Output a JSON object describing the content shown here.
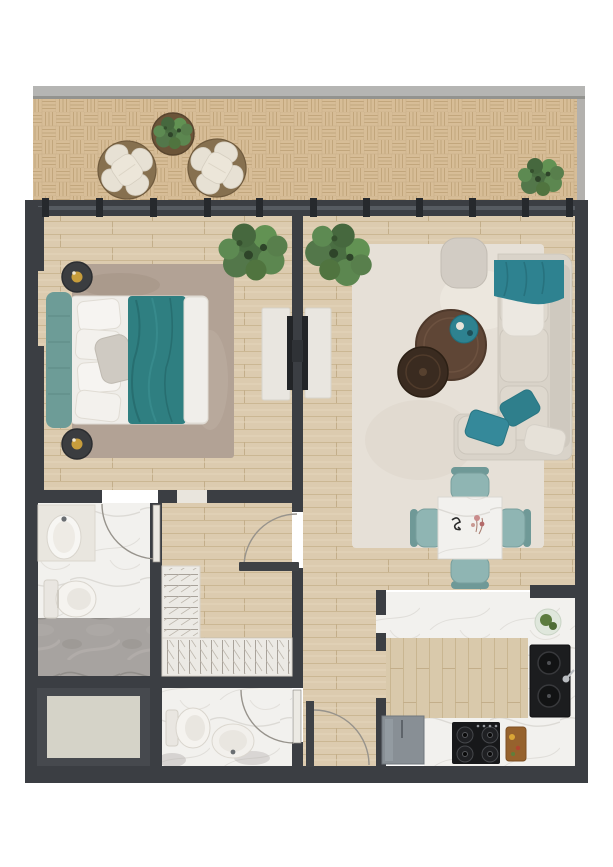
{
  "meta": {
    "title": "apartment-floor-plan",
    "description": "Top-down rendered floor plan of a one-bedroom apartment with balcony",
    "visible_text": []
  },
  "palette": {
    "wall": "#3b3e43",
    "wallDark": "#26292d",
    "glass": "#565b61",
    "rail": "#b5b5b3",
    "rugBedroom": "#b2a295",
    "rugLiving": "#e6e0d7",
    "teal": "#2e8290",
    "tealDeep": "#2f7f81",
    "tealChair": "#8fb5b3",
    "headboard": "#6d9c97",
    "sofa": "#d9d3c9",
    "cushion": "#ded8ce",
    "consoleWhite": "#e9e6e0",
    "tv": "#222427",
    "black": "#1c1d1f",
    "appliance": "#888f95",
    "storageFloor": "#d5d3c8",
    "fixture": "#f5f3ef",
    "woodBase": "#dccbaf",
    "parquetBase": "#d7bd97",
    "marble": "#f2f1ee",
    "grayMarble": "#a7a3a0",
    "gold": "#c79d3c",
    "plantGreen": "#527a46",
    "tableBrown": "#5f4636",
    "cuttingBoard": "#96622d"
  },
  "rooms": [
    {
      "id": "balcony",
      "label": "balcony",
      "items": [
        "lounge chair",
        "lounge chair",
        "round planter table with plant",
        "potted plant",
        "parquet deck",
        "railing"
      ]
    },
    {
      "id": "bedroom",
      "label": "bedroom",
      "items": [
        "double bed with teal headboard",
        "teal throw blanket",
        "white pillows",
        "area rug",
        "bedside table with lamp",
        "bedside table with lamp",
        "potted plant",
        "tv console",
        "wall tv"
      ]
    },
    {
      "id": "living-room",
      "label": "living room",
      "items": [
        "shag area rug",
        "sofa with chaise",
        "teal throw",
        "teal cushions",
        "pouf",
        "nesting round coffee tables",
        "teal decor tray",
        "potted plant",
        "tv console",
        "wall tv"
      ]
    },
    {
      "id": "dining-area",
      "label": "dining area",
      "items": [
        "square marble dining table",
        "dining chair",
        "dining chair",
        "dining chair",
        "dining chair",
        "table decor"
      ]
    },
    {
      "id": "kitchen",
      "label": "kitchen",
      "items": [
        "l-shaped marble counter",
        "double-bowl black sink",
        "gas cooktop",
        "cutting board with food",
        "refrigerator",
        "fruit plate"
      ]
    },
    {
      "id": "bathroom-1",
      "label": "en-suite bathroom",
      "items": [
        "vanity with oval washbasin",
        "toilet",
        "marble shower area",
        "door"
      ]
    },
    {
      "id": "walk-in-closet",
      "label": "hall / walk-in closet",
      "items": [
        "l-shaped wardrobe with hanging rails",
        "door to living room",
        "open doorway to bedroom"
      ]
    },
    {
      "id": "bathroom-2",
      "label": "guest bathroom",
      "items": [
        "toilet",
        "oval washbasin",
        "door"
      ]
    },
    {
      "id": "storage",
      "label": "storage / shaft",
      "items": []
    },
    {
      "id": "entry",
      "label": "entry passage",
      "items": [
        "entrance door"
      ]
    }
  ]
}
